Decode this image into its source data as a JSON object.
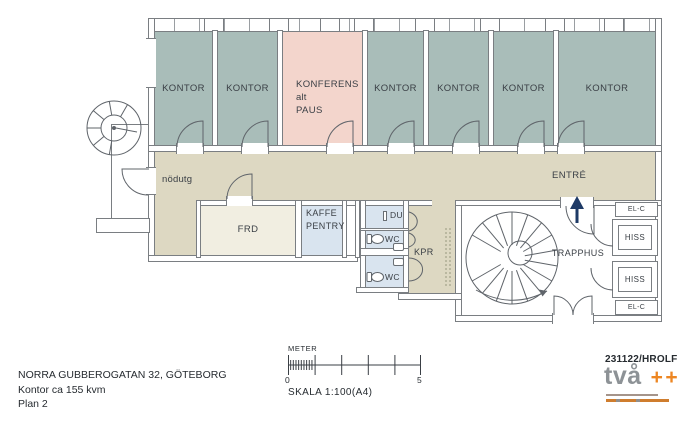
{
  "plan": {
    "offices": [
      "KONTOR",
      "KONTOR",
      "KONTOR",
      "KONTOR",
      "KONTOR",
      "KONTOR"
    ],
    "conference": {
      "line1": "KONFERENS",
      "line2": "alt",
      "line3": "PAUS"
    },
    "labels": {
      "emergency_exit": "nödutg",
      "entrance": "ENTRÉ",
      "storage": "FRD",
      "pentry_line1": "KAFFE",
      "pentry_line2": "PENTRY",
      "shower": "DU",
      "wc_upper": "WC",
      "wc_lower": "WC",
      "cleaning": "KPR",
      "stairwell": "TRAPPHUS",
      "elevator_upper": "HISS",
      "elevator_lower": "HISS",
      "electrical_top": "EL-C",
      "electrical_bottom": "EL-C"
    },
    "colors": {
      "office": "#a9bdb9",
      "conference": "#f3d5cc",
      "corridor": "#ddd8c2",
      "wet_room": "#d9e4ef",
      "storage_room": "#f1eee1",
      "wall_outline": "#7a7e82",
      "entry_arrow": "#1e3a66"
    }
  },
  "title_block": {
    "address": "NORRA GUBBEROGATAN 32, GÖTEBORG",
    "area": "Kontor ca 155 kvm",
    "floor": "Plan 2"
  },
  "scale_bar": {
    "unit": "METER",
    "start_value": "0",
    "end_value": "5",
    "scale": "SKALA 1:100(A4)"
  },
  "stamp": {
    "reference": "231122/HROLF",
    "logo_text": "två",
    "logo_suffix": "++",
    "logo_text_color": "#8d9296",
    "logo_suffix_color": "#ed8622"
  }
}
